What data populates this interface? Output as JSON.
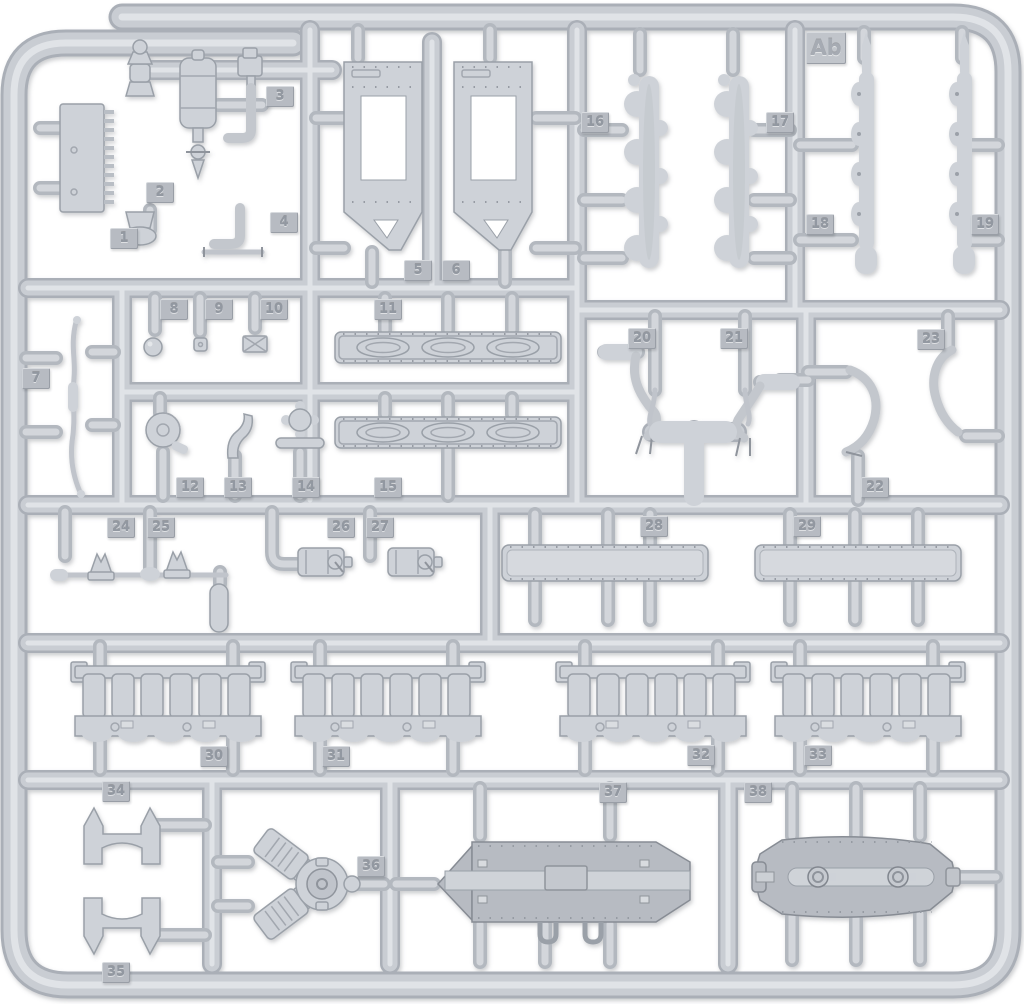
{
  "meta": {
    "subject": "injection-molded model kit sprue photo",
    "sprue_letter": "Ab",
    "part_count": 38
  },
  "colors": {
    "background": "#ffffff",
    "plastic": "#ced2d8",
    "plastic_mid": "#c9cdd3",
    "plastic_edge": "#aaafb7",
    "plastic_highlight": "#e0e3e7",
    "plastic_dark": "#b7bbc2",
    "tag_background": "#b7bbc2",
    "tag_text": "#9298a1"
  },
  "part_tags": [
    {
      "label": "1",
      "x": 110,
      "y": 228
    },
    {
      "label": "2",
      "x": 146,
      "y": 182
    },
    {
      "label": "3",
      "x": 266,
      "y": 86
    },
    {
      "label": "4",
      "x": 270,
      "y": 212
    },
    {
      "label": "5",
      "x": 404,
      "y": 260
    },
    {
      "label": "6",
      "x": 442,
      "y": 260
    },
    {
      "label": "7",
      "x": 22,
      "y": 368
    },
    {
      "label": "8",
      "x": 160,
      "y": 299
    },
    {
      "label": "9",
      "x": 205,
      "y": 299
    },
    {
      "label": "10",
      "x": 260,
      "y": 299
    },
    {
      "label": "11",
      "x": 374,
      "y": 299
    },
    {
      "label": "12",
      "x": 176,
      "y": 477
    },
    {
      "label": "13",
      "x": 224,
      "y": 477
    },
    {
      "label": "14",
      "x": 292,
      "y": 477
    },
    {
      "label": "15",
      "x": 374,
      "y": 477
    },
    {
      "label": "16",
      "x": 581,
      "y": 112
    },
    {
      "label": "17",
      "x": 766,
      "y": 112
    },
    {
      "label": "18",
      "x": 806,
      "y": 214
    },
    {
      "label": "19",
      "x": 971,
      "y": 214
    },
    {
      "label": "20",
      "x": 628,
      "y": 328
    },
    {
      "label": "21",
      "x": 720,
      "y": 328
    },
    {
      "label": "22",
      "x": 861,
      "y": 477
    },
    {
      "label": "23",
      "x": 917,
      "y": 329
    },
    {
      "label": "24",
      "x": 107,
      "y": 517
    },
    {
      "label": "25",
      "x": 147,
      "y": 517
    },
    {
      "label": "26",
      "x": 327,
      "y": 517
    },
    {
      "label": "27",
      "x": 366,
      "y": 517
    },
    {
      "label": "28",
      "x": 640,
      "y": 516
    },
    {
      "label": "29",
      "x": 793,
      "y": 516
    },
    {
      "label": "30",
      "x": 200,
      "y": 746
    },
    {
      "label": "31",
      "x": 322,
      "y": 746
    },
    {
      "label": "32",
      "x": 687,
      "y": 745
    },
    {
      "label": "33",
      "x": 804,
      "y": 745
    },
    {
      "label": "34",
      "x": 102,
      "y": 781
    },
    {
      "label": "35",
      "x": 102,
      "y": 962
    },
    {
      "label": "36",
      "x": 357,
      "y": 856
    },
    {
      "label": "37",
      "x": 599,
      "y": 782
    },
    {
      "label": "38",
      "x": 744,
      "y": 782
    },
    {
      "label": "Ab",
      "x": 806,
      "y": 32,
      "kind": "letter"
    }
  ]
}
